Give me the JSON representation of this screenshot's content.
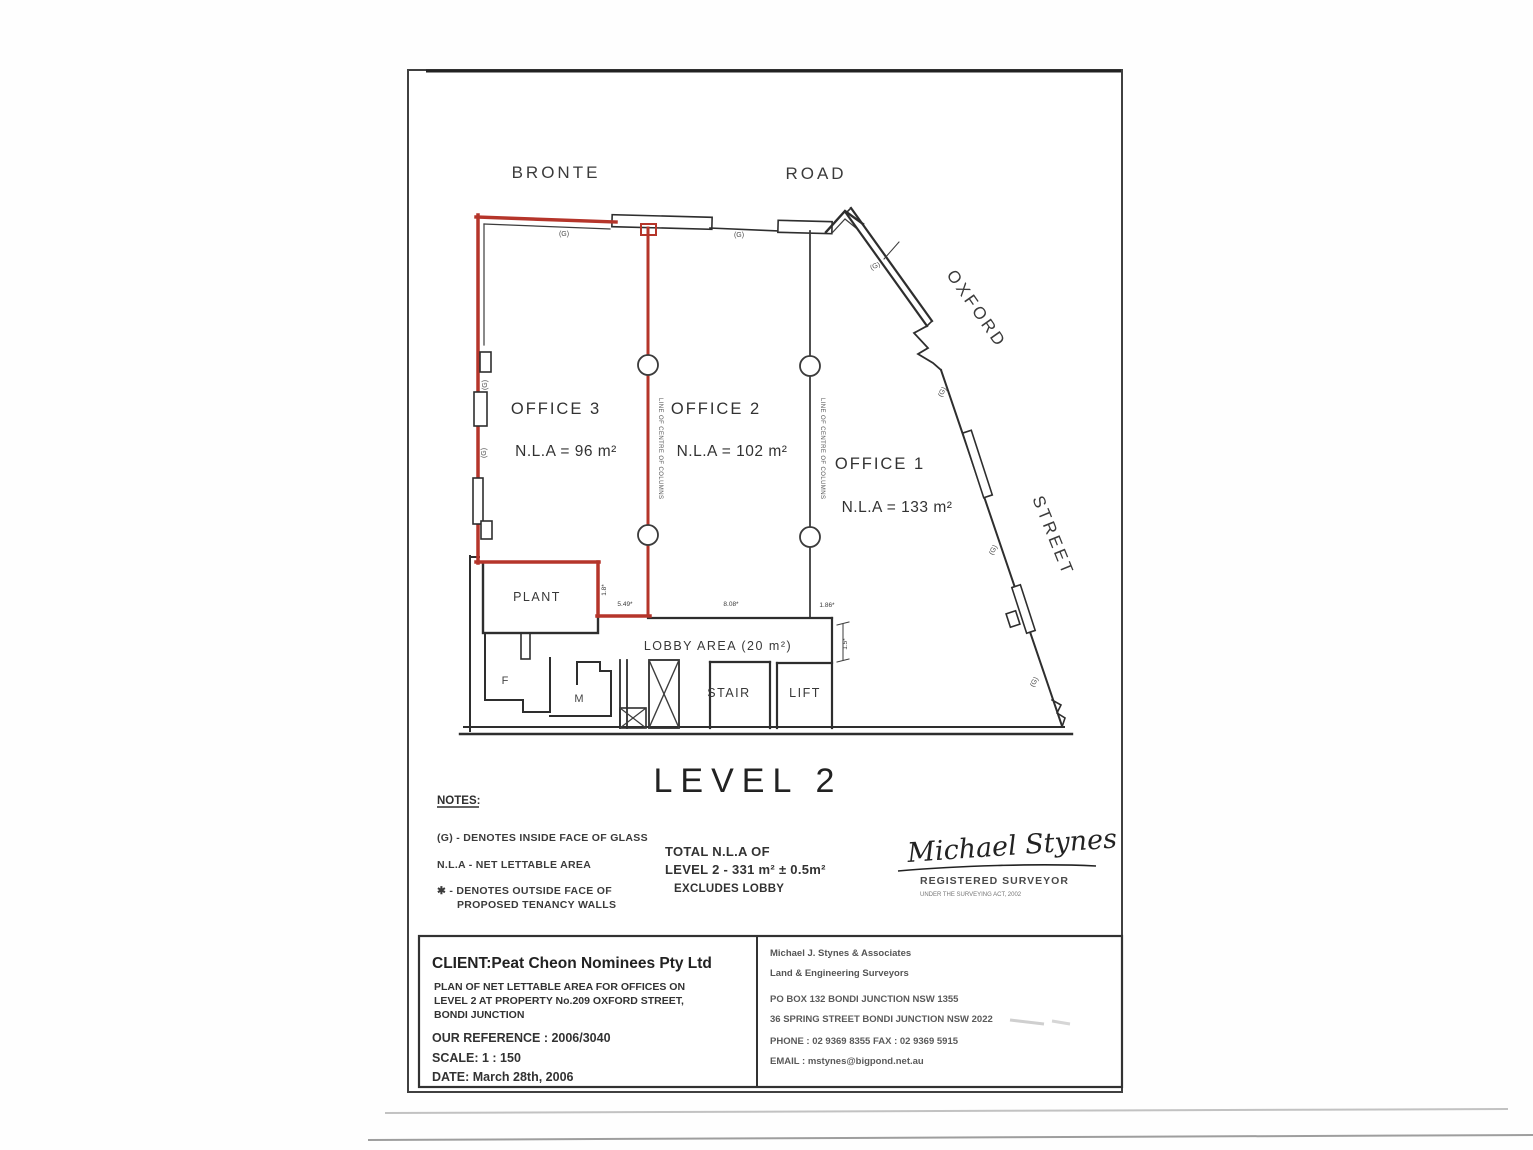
{
  "document": {
    "level_title": "LEVEL 2",
    "streets": {
      "bronte": "BRONTE",
      "road": "ROAD",
      "oxford": "OXFORD",
      "street": "STREET"
    },
    "offices": [
      {
        "name": "OFFICE 3",
        "nla": "N.L.A = 96 m²"
      },
      {
        "name": "OFFICE 2",
        "nla": "N.L.A = 102 m²"
      },
      {
        "name": "OFFICE 1",
        "nla": "N.L.A = 133 m²"
      }
    ],
    "rooms": {
      "plant": "PLANT",
      "lobby": "LOBBY AREA (20 m²)",
      "stair": "STAIR",
      "lift": "LIFT",
      "female": "F",
      "male": "M"
    },
    "markers": {
      "glass": "(G)",
      "column_line": "LINE OF CENTRE OF COLUMNS"
    },
    "dimensions": {
      "d1": "5.49*",
      "d2": "8.08*",
      "d3": "1.86*",
      "v1": "1.5*",
      "v2": "1.8*"
    },
    "notes": {
      "heading": "NOTES:",
      "line1": "(G) - DENOTES INSIDE FACE OF GLASS",
      "line2": "N.L.A - NET LETTABLE AREA",
      "line3": "✱ - DENOTES OUTSIDE FACE OF",
      "line4": "PROPOSED TENANCY WALLS"
    },
    "total": {
      "line1": "TOTAL N.L.A OF",
      "line2": "LEVEL 2 - 331 m² ± 0.5m²",
      "line3": "EXCLUDES LOBBY"
    },
    "signature": {
      "name": "Michael Stynes",
      "title": "REGISTERED SURVEYOR",
      "subtitle": "UNDER THE SURVEYING ACT, 2002"
    },
    "title_block": {
      "client": "CLIENT:Peat Cheon Nominees Pty Ltd",
      "plan_line1": "PLAN OF NET LETTABLE AREA FOR OFFICES ON",
      "plan_line2": "LEVEL 2 AT PROPERTY No.209 OXFORD STREET,",
      "plan_line3": "BONDI JUNCTION",
      "reference": "OUR REFERENCE : 2006/3040",
      "scale": "SCALE: 1 : 150",
      "date": "DATE: March 28th, 2006",
      "surveyor_firm": "Michael J. Stynes & Associates",
      "surveyor_type": "Land & Engineering Surveyors",
      "address1": "PO BOX 132 BONDI JUNCTION  NSW  1355",
      "address2": "36 SPRING STREET BONDI JUNCTION NSW 2022",
      "phone_fax": "PHONE :  02 9369 8355    FAX :  02 9369 5915",
      "email": "EMAIL :  mstynes@bigpond.net.au"
    },
    "colors": {
      "tenancy_red": "#b5342c",
      "ink": "#2e2e2e"
    }
  }
}
